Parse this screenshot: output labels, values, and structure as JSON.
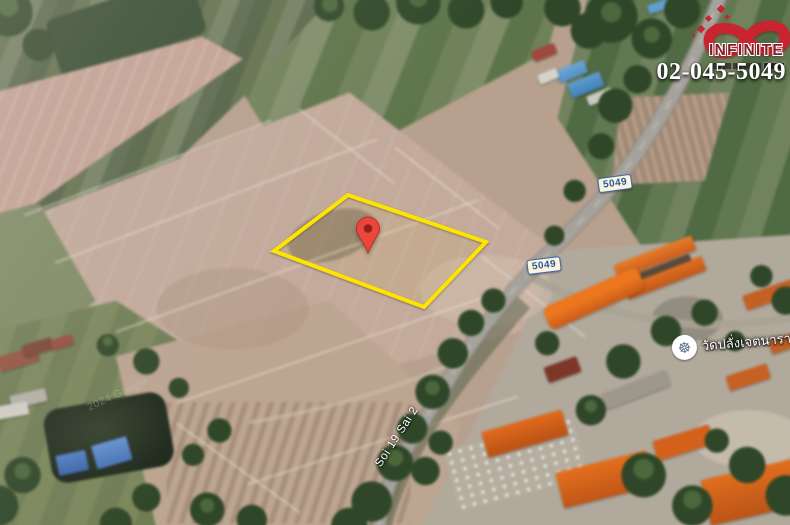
{
  "branding": {
    "logo_icon": "infinity-icon",
    "logo_text": "INFINITE",
    "phone": "02-045-5049",
    "logo_red": "#c92430",
    "logo_text_color": "#7e2228"
  },
  "map": {
    "road_badges": [
      {
        "label": "5049"
      },
      {
        "label": "5049"
      }
    ],
    "road_label": "Soi 19 Sai 2",
    "poi": {
      "icon": "buddhist-temple-icon",
      "icon_glyph": "☸",
      "label": "วัดปลั่งเจตนาราษฎร์"
    },
    "watermark": "2024 Google",
    "parcel": {
      "outline_color": "#ffe400",
      "marker_color": "#e9473d",
      "marker_dot_color": "#942017"
    },
    "badge_colors": {
      "background": "#faf4da",
      "border": "#3a66ae",
      "text": "#2a58a8"
    }
  }
}
